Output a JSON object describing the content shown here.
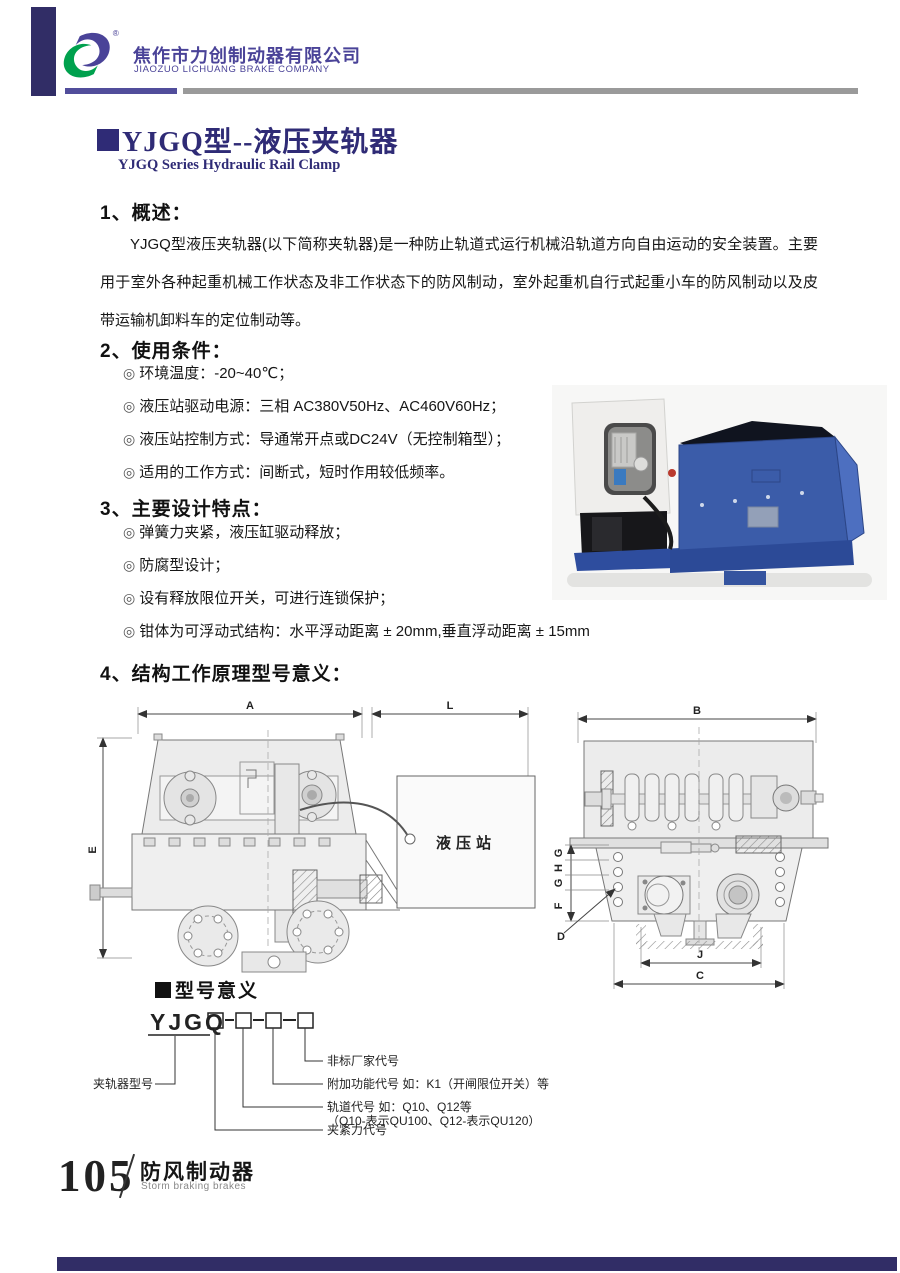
{
  "glyphs": {
    "bullet": "◎",
    "registered": "®"
  },
  "header": {
    "company_cn": "焦作市力创制动器有限公司",
    "company_en": "JIAOZUO LICHUANG BRAKE COMPANY"
  },
  "title": {
    "main": "YJGQ型--液压夹轨器",
    "sub": "YJGQ Series Hydraulic Rail Clamp"
  },
  "sections": {
    "overview": {
      "heading": "1、概述：",
      "body": "YJGQ型液压夹轨器(以下简称夹轨器)是一种防止轨道式运行机械沿轨道方向自由运动的安全装置。主要用于室外各种起重机械工作状态及非工作状态下的防风制动，室外起重机自行式起重小车的防风制动以及皮带运输机卸料车的定位制动等。"
    },
    "conditions": {
      "heading": "2、使用条件：",
      "items": [
        "环境温度：-20~40℃；",
        "液压站驱动电源：三相 AC380V50Hz、AC460V60Hz；",
        "液压站控制方式：导通常开点或DC24V（无控制箱型）；",
        "适用的工作方式：间断式，短时作用较低频率。"
      ]
    },
    "features": {
      "heading": "3、主要设计特点：",
      "items": [
        "弹簧力夹紧，液压缸驱动释放；",
        "防腐型设计；",
        "设有释放限位开关，可进行连锁保护；",
        "钳体为可浮动式结构：水平浮动距离 ± 20mm,垂直浮动距离 ± 15mm"
      ]
    },
    "structure": {
      "heading": "4、结构工作原理型号意义："
    }
  },
  "drawings": {
    "side_view": {
      "dim_a": "A",
      "dim_l": "L",
      "dim_e": "E",
      "station_label": "液压站"
    },
    "front_view": {
      "dim_b": "B",
      "dim_g": "G",
      "dim_h": "H",
      "dim_f": "F",
      "dim_d": "D",
      "dim_j": "J",
      "dim_c": "C"
    }
  },
  "model_meaning": {
    "heading": "型号意义",
    "model_prefix": "YJGQ",
    "left_label": "夹轨器型号",
    "label_nonstandard": "非标厂家代号",
    "label_function": "附加功能代号 如：K1（开闸限位开关）等",
    "label_rail": "轨道代号 如：Q10、Q12等",
    "label_rail_note": "（Q10-表示QU100、Q12-表示QU120）",
    "label_force": "夹紧力代号"
  },
  "footer": {
    "page_number": "105",
    "category_cn": "防风制动器",
    "category_en": "Storm braking brakes"
  },
  "colors": {
    "brand_purple": "#4a4398",
    "brand_green": "#00a14e",
    "title_navy": "#2f2b76",
    "accent_bar_navy": "#312d66"
  }
}
